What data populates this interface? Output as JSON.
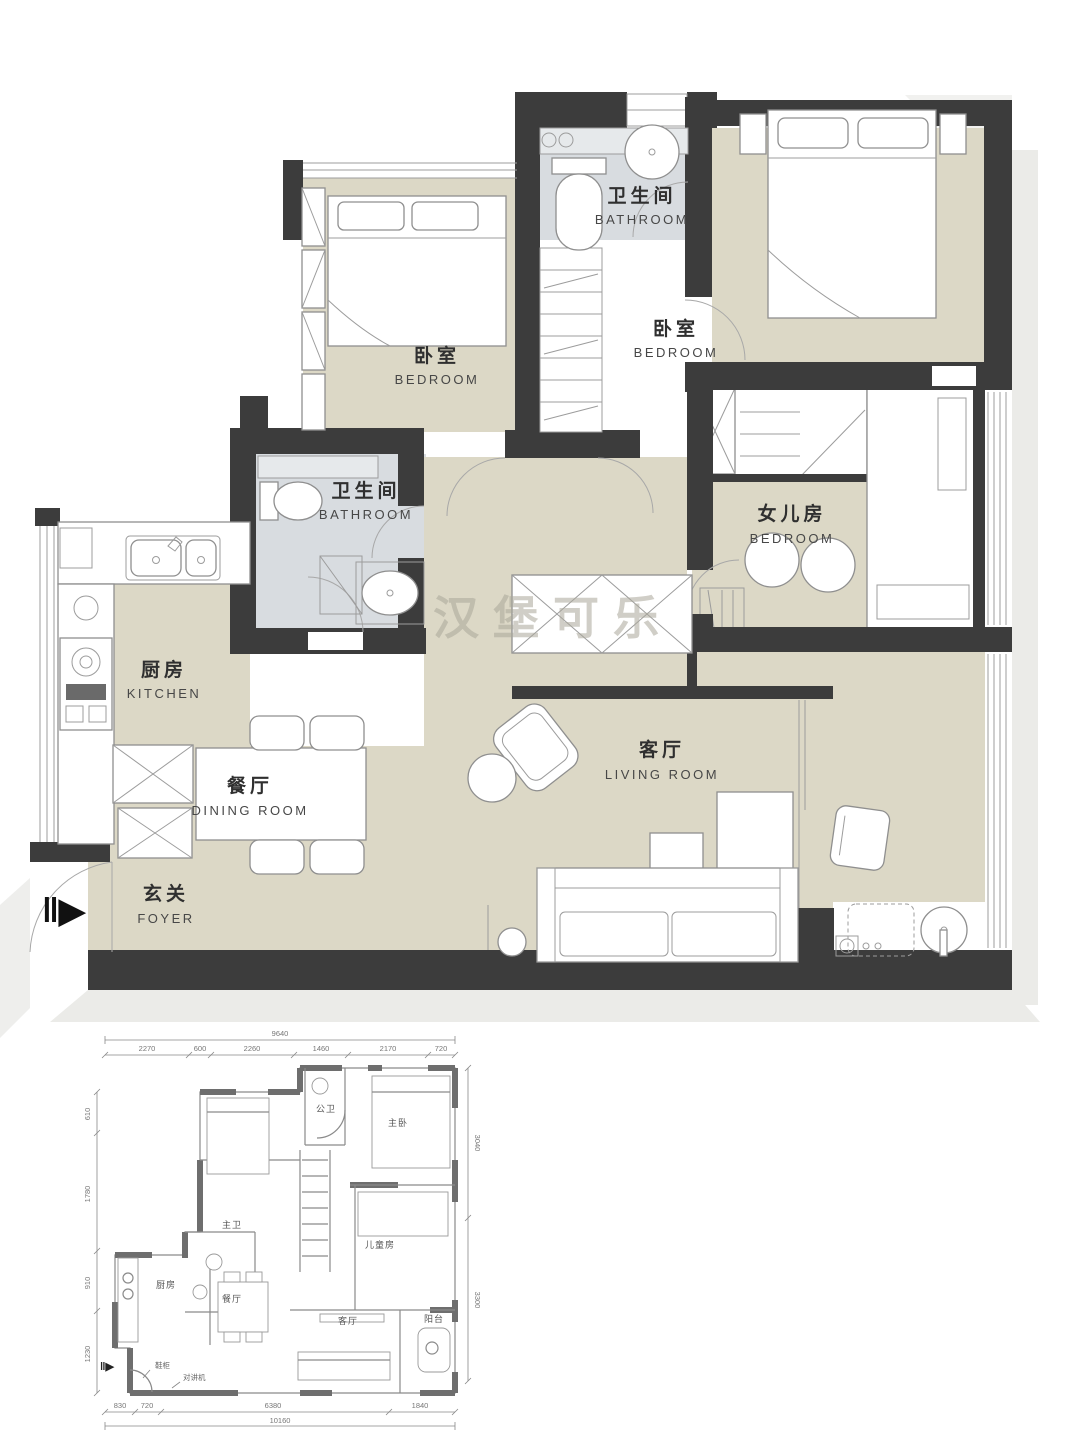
{
  "main_plan": {
    "watermark": "汉堡可乐",
    "entry_arrow": "‖▶",
    "rooms": {
      "bathroom_top": {
        "zh": "卫生间",
        "en": "BATHROOM"
      },
      "bedroom_left": {
        "zh": "卧室",
        "en": "BEDROOM"
      },
      "bedroom_right": {
        "zh": "卧室",
        "en": "BEDROOM"
      },
      "daughter_room": {
        "zh": "女儿房",
        "en": "BEDROOM"
      },
      "bathroom_mid": {
        "zh": "卫生间",
        "en": "BATHROOM"
      },
      "kitchen": {
        "zh": "厨房",
        "en": "KITCHEN"
      },
      "dining": {
        "zh": "餐厅",
        "en": "DINING ROOM"
      },
      "foyer": {
        "zh": "玄关",
        "en": "FOYER"
      },
      "living": {
        "zh": "客厅",
        "en": "LIVING ROOM"
      }
    }
  },
  "small_plan": {
    "entry_arrow": "‖▶",
    "labels": {
      "bath_public": "公卫",
      "master": "主卧",
      "bath_master": "主卫",
      "kids": "儿童房",
      "kitchen": "厨房",
      "dining": "餐厅",
      "living": "客厅",
      "balcony": "阳台",
      "shoe_cabinet": "鞋柜",
      "intercom": "对讲机"
    },
    "dims": {
      "top_total": "9640",
      "top": [
        "2270",
        "600",
        "2260",
        "1460",
        "2170",
        "720"
      ],
      "left": [
        "610",
        "1780",
        "910",
        "1230"
      ],
      "right": [
        "3040",
        "3300"
      ],
      "bottom": [
        "830",
        "720",
        "6380",
        "1840"
      ],
      "bottom_total": "10160"
    }
  },
  "colors": {
    "wall": "#3c3c3c",
    "floor_beige": "#dcd8c6",
    "bath_floor": "#d8dce0",
    "shadow": "#ebebe8",
    "small_wall": "#6e6e6e"
  }
}
